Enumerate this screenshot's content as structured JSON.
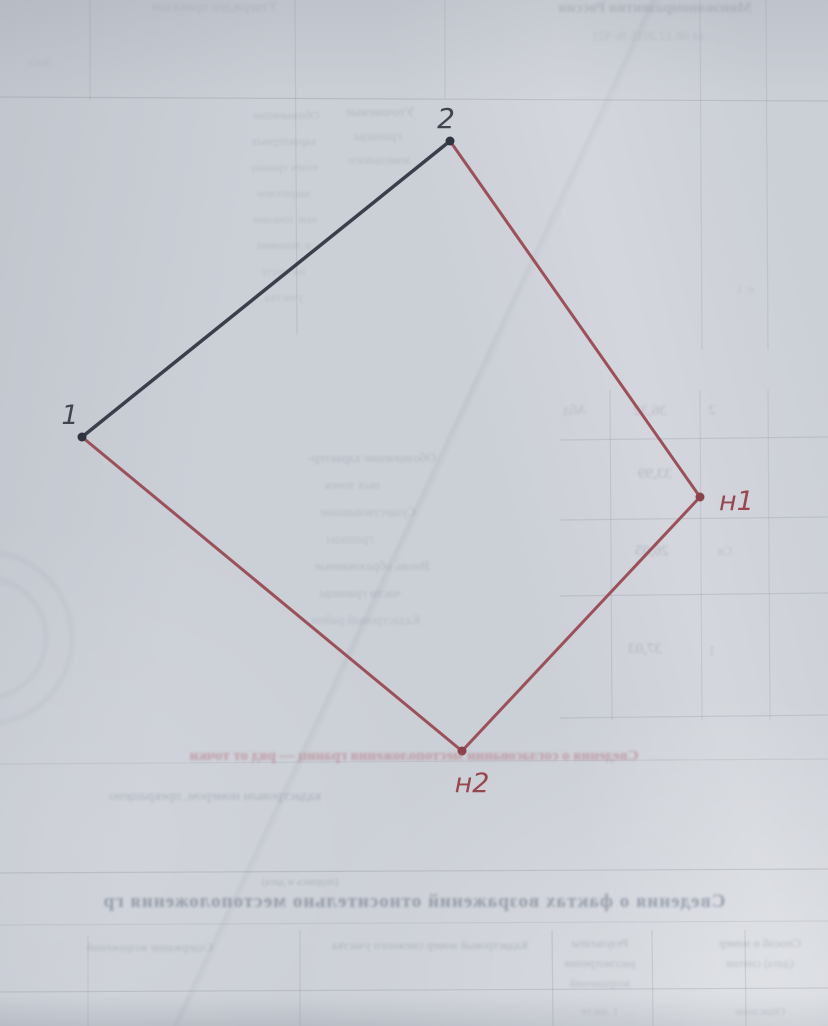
{
  "document": {
    "kind_note": "photographed page of a cadastral boundary plan with bleed-through from reverse side",
    "paper_color": "#cbcfd6"
  },
  "diagram": {
    "points": [
      {
        "id": "1",
        "label": "1",
        "x": 82,
        "y": 437,
        "dot_color": "#30343e",
        "label_x": 70,
        "label_y": 424,
        "label_anchor": "middle",
        "label_color": "#41454f",
        "label_size": 27
      },
      {
        "id": "2",
        "label": "2",
        "x": 450,
        "y": 141,
        "dot_color": "#30343e",
        "label_x": 446,
        "label_y": 128,
        "label_anchor": "middle",
        "label_color": "#41454f",
        "label_size": 28
      },
      {
        "id": "n1",
        "label": "н1",
        "x": 700,
        "y": 497,
        "dot_color": "#8c424b",
        "label_x": 719,
        "label_y": 510,
        "label_anchor": "start",
        "label_color": "#98474f",
        "label_size": 27
      },
      {
        "id": "n2",
        "label": "н2",
        "x": 462,
        "y": 751,
        "dot_color": "#8c424b",
        "label_x": 472,
        "label_y": 792,
        "label_anchor": "middle",
        "label_color": "#98474f",
        "label_size": 27
      }
    ],
    "edges": [
      {
        "from": "1",
        "to": "2",
        "color": "#3a3f4c",
        "width": 3.5
      },
      {
        "from": "2",
        "to": "n1",
        "color": "#9c5059",
        "width": 3
      },
      {
        "from": "n1",
        "to": "n2",
        "color": "#9c5059",
        "width": 3
      },
      {
        "from": "n2",
        "to": "1",
        "color": "#9c5059",
        "width": 3
      }
    ],
    "dot_radius": 4.5
  },
  "bleedthrough": {
    "texts": [
      {
        "t": "Утвержден приказом",
        "x": 215,
        "y": 0,
        "s": 14,
        "o": 0.15,
        "w": 400,
        "c": "#5f6673",
        "b": 1.2
      },
      {
        "t": "Минэкономразвития России",
        "x": 655,
        "y": 0,
        "s": 15,
        "o": 0.2,
        "w": 700,
        "c": "#5f6673",
        "b": 1.2
      },
      {
        "t": "от 08.12.2015 № 921",
        "x": 648,
        "y": 28,
        "s": 13,
        "o": 0.15,
        "w": 400,
        "c": "#5f6673",
        "b": 1.2
      },
      {
        "t": "Лист",
        "x": 40,
        "y": 55,
        "s": 12,
        "o": 0.12,
        "w": 400,
        "c": "#5f6673",
        "b": 1.2
      },
      {
        "t": "Уточняемые",
        "x": 380,
        "y": 104,
        "s": 13,
        "o": 0.2,
        "w": 400,
        "c": "#5f6673",
        "b": 1.1
      },
      {
        "t": "границы",
        "x": 378,
        "y": 128,
        "s": 13,
        "o": 0.18,
        "w": 400,
        "c": "#5f6673",
        "b": 1.1
      },
      {
        "t": "земельного",
        "x": 380,
        "y": 152,
        "s": 13,
        "o": 0.18,
        "w": 400,
        "c": "#5f6673",
        "b": 1.1
      },
      {
        "t": "Обозначение",
        "x": 286,
        "y": 108,
        "s": 12,
        "o": 0.18,
        "w": 400,
        "c": "#5f6673",
        "b": 1.1
      },
      {
        "t": "характерных",
        "x": 284,
        "y": 134,
        "s": 12,
        "o": 0.18,
        "w": 400,
        "c": "#5f6673",
        "b": 1.1
      },
      {
        "t": "точек границ",
        "x": 285,
        "y": 160,
        "s": 12,
        "o": 0.17,
        "w": 400,
        "c": "#5f6673",
        "b": 1.1
      },
      {
        "t": "закреплен-",
        "x": 283,
        "y": 186,
        "s": 12,
        "o": 0.17,
        "w": 400,
        "c": "#5f6673",
        "b": 1.1
      },
      {
        "t": "ные точками",
        "x": 285,
        "y": 212,
        "s": 12,
        "o": 0.16,
        "w": 400,
        "c": "#5f6673",
        "b": 1.1
      },
      {
        "t": "и линиями",
        "x": 284,
        "y": 238,
        "s": 12,
        "o": 0.16,
        "w": 400,
        "c": "#5f6673",
        "b": 1.1
      },
      {
        "t": "на месте",
        "x": 283,
        "y": 264,
        "s": 12,
        "o": 0.15,
        "w": 400,
        "c": "#5f6673",
        "b": 1.1
      },
      {
        "t": "участка",
        "x": 284,
        "y": 290,
        "s": 12,
        "o": 0.14,
        "w": 400,
        "c": "#5f6673",
        "b": 1.1
      },
      {
        "t": "Є 1",
        "x": 745,
        "y": 283,
        "s": 12,
        "o": 0.15,
        "w": 400,
        "c": "#5f6673",
        "b": 1.2
      },
      {
        "t": "Обозначение характер-",
        "x": 372,
        "y": 450,
        "s": 13,
        "o": 0.2,
        "w": 400,
        "c": "#5f6673",
        "b": 1.1
      },
      {
        "t": "ных точек",
        "x": 352,
        "y": 477,
        "s": 13,
        "o": 0.18,
        "w": 400,
        "c": "#5f6673",
        "b": 1.1
      },
      {
        "t": "Существовавшие",
        "x": 368,
        "y": 504,
        "s": 13,
        "o": 0.18,
        "w": 400,
        "c": "#5f6673",
        "b": 1.1
      },
      {
        "t": "границы",
        "x": 350,
        "y": 531,
        "s": 13,
        "o": 0.16,
        "w": 400,
        "c": "#5f6673",
        "b": 1.1
      },
      {
        "t": "Вновь образованные",
        "x": 372,
        "y": 558,
        "s": 13,
        "o": 0.2,
        "w": 400,
        "c": "#5f6673",
        "b": 1.1
      },
      {
        "t": "части границы",
        "x": 360,
        "y": 585,
        "s": 13,
        "o": 0.2,
        "w": 400,
        "c": "#5f6673",
        "b": 1.1
      },
      {
        "t": "Кадастровый район",
        "x": 366,
        "y": 612,
        "s": 13,
        "o": 0.17,
        "w": 400,
        "c": "#5f6673",
        "b": 1.1
      },
      {
        "t": "Абд",
        "x": 575,
        "y": 403,
        "s": 14,
        "o": 0.2,
        "w": 400,
        "c": "#5f6673",
        "b": 1.1
      },
      {
        "t": "36,32",
        "x": 650,
        "y": 403,
        "s": 15,
        "o": 0.22,
        "w": 400,
        "c": "#5f6673",
        "b": 1.1
      },
      {
        "t": "2",
        "x": 712,
        "y": 403,
        "s": 14,
        "o": 0.2,
        "w": 400,
        "c": "#5f6673",
        "b": 1.1
      },
      {
        "t": "33,99",
        "x": 655,
        "y": 466,
        "s": 15,
        "o": 0.25,
        "w": 400,
        "c": "#5f6673",
        "b": 1.1
      },
      {
        "t": "26,05",
        "x": 652,
        "y": 543,
        "s": 15,
        "o": 0.25,
        "w": 400,
        "c": "#5f6673",
        "b": 1.1
      },
      {
        "t": "Св",
        "x": 725,
        "y": 543,
        "s": 13,
        "o": 0.18,
        "w": 400,
        "c": "#5f6673",
        "b": 1.1
      },
      {
        "t": "37,03",
        "x": 645,
        "y": 641,
        "s": 15,
        "o": 0.25,
        "w": 400,
        "c": "#5f6673",
        "b": 1.1
      },
      {
        "t": "1",
        "x": 712,
        "y": 643,
        "s": 13,
        "o": 0.2,
        "w": 400,
        "c": "#5f6673",
        "b": 1.1
      },
      {
        "t": "Сведения о согласовании местоположения границ — ряд от точки",
        "x": 414,
        "y": 748,
        "s": 15,
        "o": 0.5,
        "w": 700,
        "c": "#b26672",
        "b": 1.2
      },
      {
        "t": "кадастровым номером, прекращено",
        "x": 215,
        "y": 789,
        "s": 14,
        "o": 0.38,
        "w": 400,
        "c": "#7c8494",
        "b": 1.2
      },
      {
        "t": "(подпись и дата)",
        "x": 300,
        "y": 876,
        "s": 11,
        "o": 0.28,
        "w": 400,
        "c": "#5f6673",
        "b": 1.1
      },
      {
        "t": "Сведения о фактах возражений относительно местоположения гр",
        "x": 414,
        "y": 891,
        "s": 19,
        "o": 0.45,
        "w": 700,
        "c": "#4e5a6e",
        "b": 1.3,
        "ls": 1
      },
      {
        "t": "Содержание возражений",
        "x": 150,
        "y": 940,
        "s": 12,
        "o": 0.25,
        "w": 400,
        "c": "#5f6673",
        "b": 1.2
      },
      {
        "t": "Кадастровый номер смежного участка",
        "x": 430,
        "y": 938,
        "s": 12,
        "o": 0.28,
        "w": 400,
        "c": "#5f6673",
        "b": 1.2
      },
      {
        "t": "Результаты",
        "x": 600,
        "y": 936,
        "s": 12,
        "o": 0.28,
        "w": 400,
        "c": "#5f6673",
        "b": 1.2
      },
      {
        "t": "рассмотрения",
        "x": 600,
        "y": 956,
        "s": 12,
        "o": 0.25,
        "w": 400,
        "c": "#5f6673",
        "b": 1.2
      },
      {
        "t": "возражений",
        "x": 600,
        "y": 976,
        "s": 12,
        "o": 0.22,
        "w": 400,
        "c": "#5f6673",
        "b": 1.2
      },
      {
        "t": "Способ и номер",
        "x": 760,
        "y": 936,
        "s": 12,
        "o": 0.28,
        "w": 400,
        "c": "#5f6673",
        "b": 1.2
      },
      {
        "t": "(дата) снятия",
        "x": 760,
        "y": 956,
        "s": 12,
        "o": 0.24,
        "w": 400,
        "c": "#5f6673",
        "b": 1.2
      },
      {
        "t": "1 листе",
        "x": 600,
        "y": 1004,
        "s": 12,
        "o": 0.2,
        "w": 400,
        "c": "#5f6673",
        "b": 1.2
      },
      {
        "t": "Описание",
        "x": 760,
        "y": 1004,
        "s": 12,
        "o": 0.2,
        "w": 400,
        "c": "#5f6673",
        "b": 1.2
      }
    ],
    "lines": [
      {
        "x1": 0,
        "y1": 97,
        "x2": 828,
        "y2": 101,
        "o": 0.3
      },
      {
        "x1": 560,
        "y1": 440,
        "x2": 828,
        "y2": 437,
        "o": 0.25
      },
      {
        "x1": 560,
        "y1": 520,
        "x2": 828,
        "y2": 517,
        "o": 0.25
      },
      {
        "x1": 560,
        "y1": 596,
        "x2": 828,
        "y2": 593,
        "o": 0.25
      },
      {
        "x1": 560,
        "y1": 718,
        "x2": 828,
        "y2": 715,
        "o": 0.25
      },
      {
        "x1": 0,
        "y1": 764,
        "x2": 828,
        "y2": 759,
        "o": 0.18
      },
      {
        "x1": 0,
        "y1": 873,
        "x2": 828,
        "y2": 869,
        "o": 0.3
      },
      {
        "x1": 0,
        "y1": 925,
        "x2": 828,
        "y2": 921,
        "o": 0.18
      },
      {
        "x1": 0,
        "y1": 992,
        "x2": 828,
        "y2": 988,
        "o": 0.28
      },
      {
        "x1": 90,
        "y1": 0,
        "x2": 90,
        "y2": 100,
        "o": 0.22
      },
      {
        "x1": 295,
        "y1": 0,
        "x2": 297,
        "y2": 335,
        "o": 0.22
      },
      {
        "x1": 445,
        "y1": 0,
        "x2": 445,
        "y2": 98,
        "o": 0.2
      },
      {
        "x1": 700,
        "y1": 0,
        "x2": 702,
        "y2": 350,
        "o": 0.2
      },
      {
        "x1": 766,
        "y1": 0,
        "x2": 768,
        "y2": 350,
        "o": 0.2
      },
      {
        "x1": 610,
        "y1": 390,
        "x2": 612,
        "y2": 720,
        "o": 0.24
      },
      {
        "x1": 700,
        "y1": 390,
        "x2": 702,
        "y2": 720,
        "o": 0.2
      },
      {
        "x1": 768,
        "y1": 390,
        "x2": 770,
        "y2": 720,
        "o": 0.2
      },
      {
        "x1": 88,
        "y1": 935,
        "x2": 88,
        "y2": 1026,
        "o": 0.18
      },
      {
        "x1": 300,
        "y1": 930,
        "x2": 300,
        "y2": 1026,
        "o": 0.24
      },
      {
        "x1": 552,
        "y1": 930,
        "x2": 553,
        "y2": 1026,
        "o": 0.26
      },
      {
        "x1": 652,
        "y1": 930,
        "x2": 653,
        "y2": 1026,
        "o": 0.24
      },
      {
        "x1": 745,
        "y1": 930,
        "x2": 746,
        "y2": 1026,
        "o": 0.24
      }
    ],
    "line_color": "#8a8f99",
    "stamp": {
      "cx": -14,
      "cy": 638,
      "outer_r": 86,
      "inner_r": 60,
      "color": "#76808f",
      "opacity": 0.15
    }
  }
}
